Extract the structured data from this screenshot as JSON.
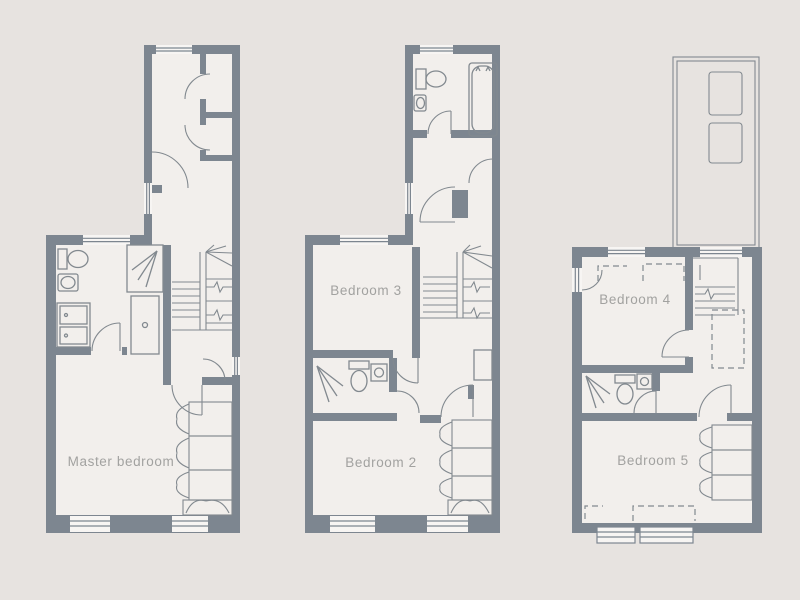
{
  "document": {
    "type": "floorplan-sheet",
    "background": "#e7e3e0"
  },
  "palette": {
    "wall": "#7d8690",
    "floor": "#f2efec",
    "line": "#82898f",
    "label_text": "#a2a2a0"
  },
  "floorplans": [
    {
      "id": "left-plan",
      "rooms": [
        {
          "label": "Master bedroom"
        }
      ],
      "features": [
        "bathroom",
        "shower",
        "vanity-unit",
        "toilet",
        "sink",
        "stairs",
        "wardrobe",
        "cupboards",
        "windows",
        "doors"
      ]
    },
    {
      "id": "middle-plan",
      "rooms": [
        {
          "label": "Bedroom 3"
        },
        {
          "label": "Bedroom 2"
        }
      ],
      "features": [
        "bathroom",
        "bathtub",
        "toilet",
        "sink",
        "shower-room",
        "stairs",
        "wardrobe",
        "windows",
        "doors"
      ]
    },
    {
      "id": "right-plan",
      "rooms": [
        {
          "label": "Bedroom 4"
        },
        {
          "label": "Bedroom 5"
        }
      ],
      "features": [
        "roof-with-skylights",
        "shower-room",
        "toilet",
        "sink",
        "stairs",
        "wardrobe",
        "dormer-windows",
        "restricted-height-dashed-lines",
        "doors"
      ]
    }
  ]
}
